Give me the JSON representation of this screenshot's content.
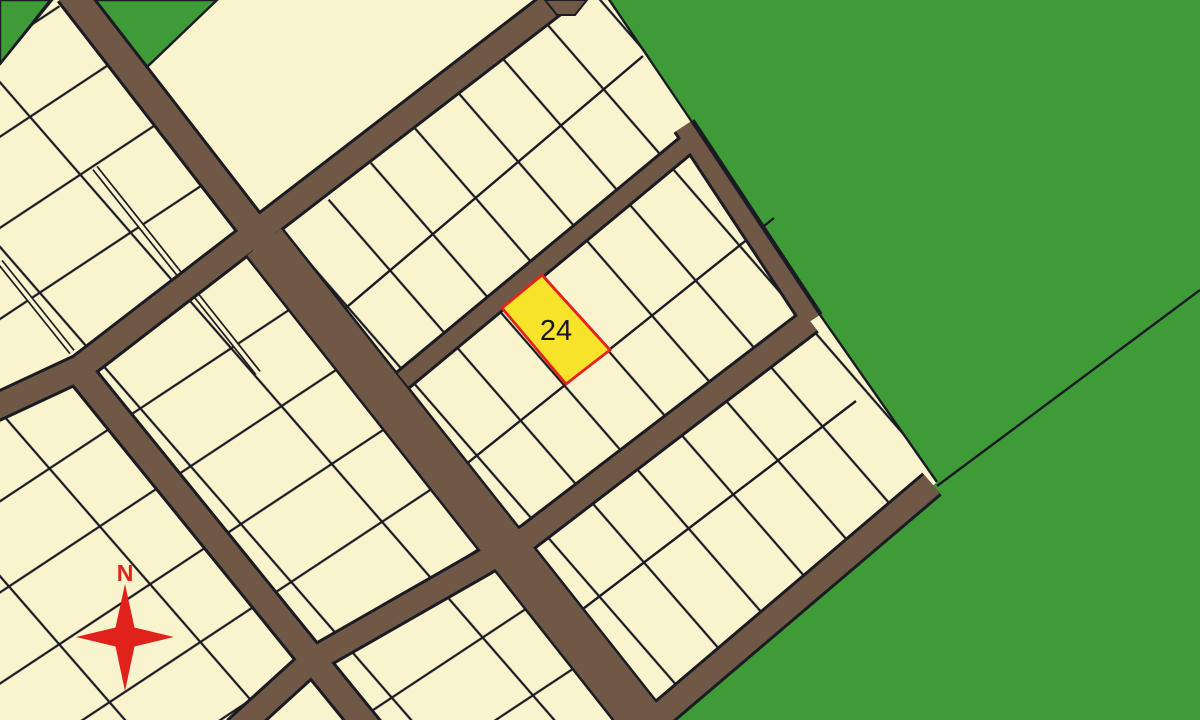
{
  "map": {
    "highlighted_parcel": {
      "label": "24"
    },
    "compass": {
      "label": "N"
    },
    "colors": {
      "greenfield": "#3F9B37",
      "parcel": "#FAF4CE",
      "road": "#6F5845",
      "line": "#1B1B24",
      "highlight-fill": "#F6E32A",
      "highlight-border": "#E3241C",
      "compass-red": "#E0211C",
      "label-ink": "#16161E"
    }
  }
}
